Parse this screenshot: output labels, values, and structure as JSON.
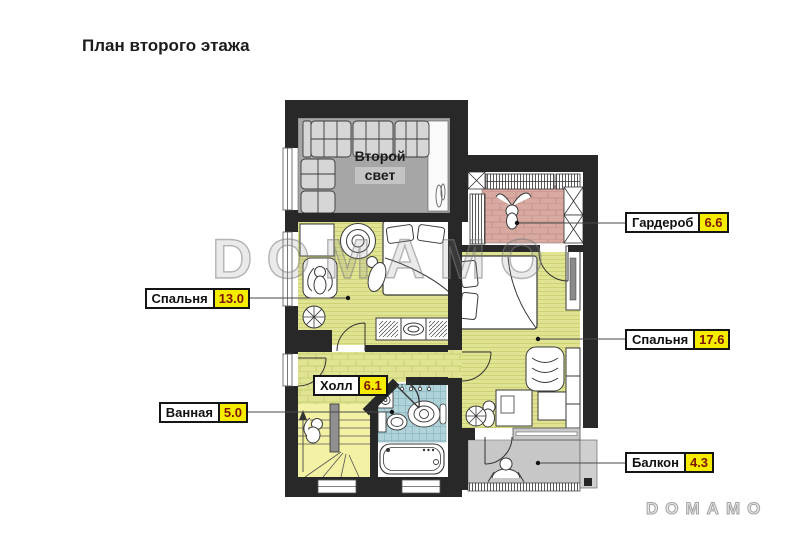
{
  "title": "План второго этажа",
  "watermarks": {
    "center": "DOMAMO",
    "corner": "DOMAMO"
  },
  "second_light": {
    "line1": "Второй",
    "line2": "свет"
  },
  "callouts": {
    "wardrobe": {
      "name": "Гардероб",
      "area": "6.6"
    },
    "bedroom_small": {
      "name": "Спальня",
      "area": "13.0"
    },
    "bedroom_large": {
      "name": "Спальня",
      "area": "17.6"
    },
    "hall": {
      "name": "Холл",
      "area": "6.1"
    },
    "bathroom": {
      "name": "Ванная",
      "area": "5.0"
    },
    "balcony": {
      "name": "Балкон",
      "area": "4.3"
    }
  },
  "colors": {
    "wall": "#282828",
    "bedroom_floor": "#e0e492",
    "wardrobe_floor": "#d8a9a1",
    "bathroom_tile": "#b0d3d9",
    "second_light_floor": "#a6a6a6",
    "balcony_floor": "#c7c7c7",
    "stairs_floor": "#f3f1a3",
    "area_badge": "#f5ec00",
    "area_text": "#7e1408"
  }
}
